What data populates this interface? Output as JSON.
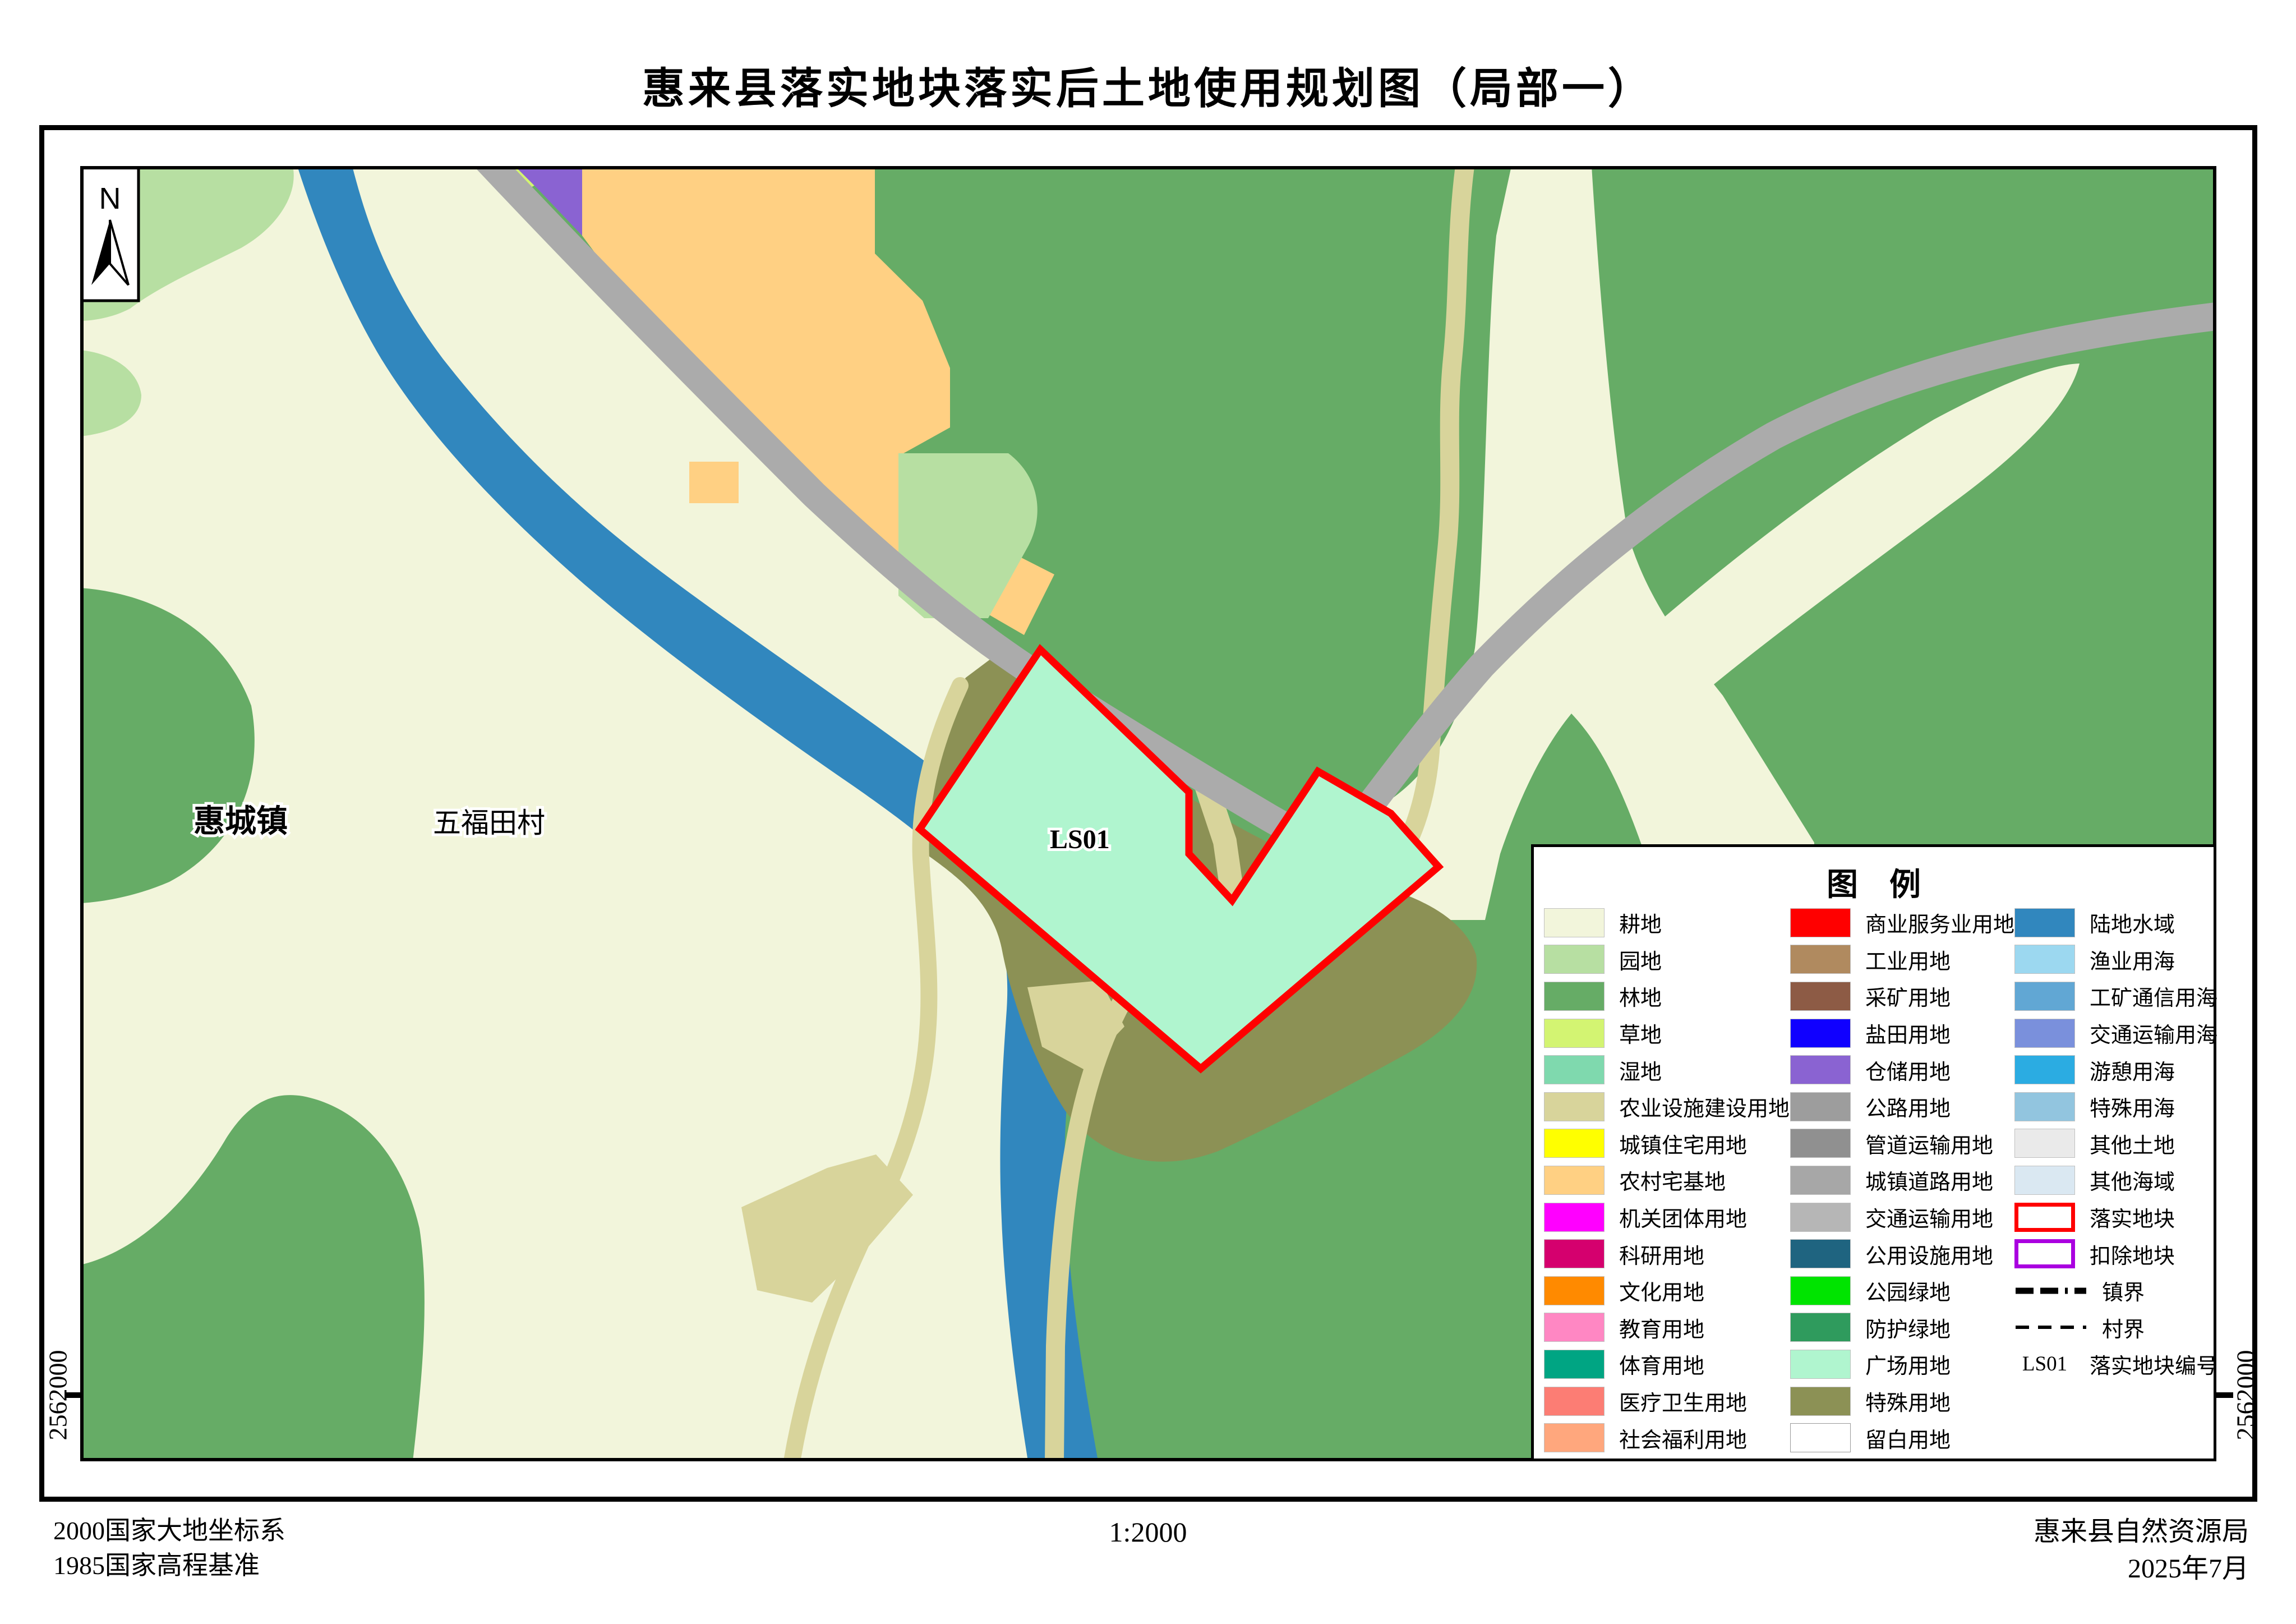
{
  "title": "惠来县落实地块落实后土地使用规划图（局部一）",
  "map": {
    "north_label": "N",
    "town_label": "惠城镇",
    "village_label": "五福田村",
    "plot_label": "LS01",
    "y_coordinate_left": "2562000",
    "y_coordinate_right": "2562000"
  },
  "legend": {
    "title": "图　例",
    "columns": [
      {
        "items": [
          {
            "label": "耕地",
            "color": "#F2F5DB"
          },
          {
            "label": "园地",
            "color": "#B7DFA2"
          },
          {
            "label": "林地",
            "color": "#66AC66"
          },
          {
            "label": "草地",
            "color": "#D3F472"
          },
          {
            "label": "湿地",
            "color": "#7FD9AE"
          },
          {
            "label": "农业设施建设用地",
            "color": "#D8D49B"
          },
          {
            "label": "城镇住宅用地",
            "color": "#FFFF00"
          },
          {
            "label": "农村宅基地",
            "color": "#FFD083"
          },
          {
            "label": "机关团体用地",
            "color": "#FF00FF"
          },
          {
            "label": "科研用地",
            "color": "#D5006E"
          },
          {
            "label": "文化用地",
            "color": "#FF8A00"
          },
          {
            "label": "教育用地",
            "color": "#FF87C3"
          },
          {
            "label": "体育用地",
            "color": "#00A583"
          },
          {
            "label": "医疗卫生用地",
            "color": "#FC7D74"
          },
          {
            "label": "社会福利用地",
            "color": "#FFA77D"
          }
        ]
      },
      {
        "items": [
          {
            "label": "商业服务业用地",
            "color": "#FF0000"
          },
          {
            "label": "工业用地",
            "color": "#B08A5F"
          },
          {
            "label": "采矿用地",
            "color": "#8D5B45"
          },
          {
            "label": "盐田用地",
            "color": "#1000FF"
          },
          {
            "label": "仓储用地",
            "color": "#8A63D2"
          },
          {
            "label": "公路用地",
            "color": "#9D9D9D"
          },
          {
            "label": "管道运输用地",
            "color": "#909090"
          },
          {
            "label": "城镇道路用地",
            "color": "#A7A7A7"
          },
          {
            "label": "交通运输用地",
            "color": "#B6B6B6"
          },
          {
            "label": "公用设施用地",
            "color": "#1F6480"
          },
          {
            "label": "公园绿地",
            "color": "#00E400"
          },
          {
            "label": "防护绿地",
            "color": "#2F9B5D"
          },
          {
            "label": "广场用地",
            "color": "#B0F5CF"
          },
          {
            "label": "特殊用地",
            "color": "#8C9155"
          },
          {
            "label": "留白用地",
            "color": "#FFFFFF",
            "type": "blank"
          }
        ]
      },
      {
        "items": [
          {
            "label": "陆地水域",
            "color": "#3187BE"
          },
          {
            "label": "渔业用海",
            "color": "#9CD8F0"
          },
          {
            "label": "工矿通信用海",
            "color": "#61A7D4"
          },
          {
            "label": "交通运输用海",
            "color": "#7A90DC"
          },
          {
            "label": "游憩用海",
            "color": "#2BACE2"
          },
          {
            "label": "特殊用海",
            "color": "#92C5DF"
          },
          {
            "label": "其他土地",
            "color": "#EAEAEA"
          },
          {
            "label": "其他海域",
            "color": "#DAE8F2"
          },
          {
            "label": "落实地块",
            "color": "#FF0000",
            "type": "outline"
          },
          {
            "label": "扣除地块",
            "color": "#AA00E0",
            "type": "outline"
          },
          {
            "label": "镇界",
            "type": "dashdot"
          },
          {
            "label": "村界",
            "type": "dash"
          },
          {
            "label": "落实地块编号",
            "type": "text",
            "symbol": "LS01"
          }
        ]
      }
    ]
  },
  "footer": {
    "datum_line1": "2000国家大地坐标系",
    "datum_line2": "1985国家高程基准",
    "scale": "1:2000",
    "agency": "惠来县自然资源局",
    "date": "2025年7月"
  }
}
